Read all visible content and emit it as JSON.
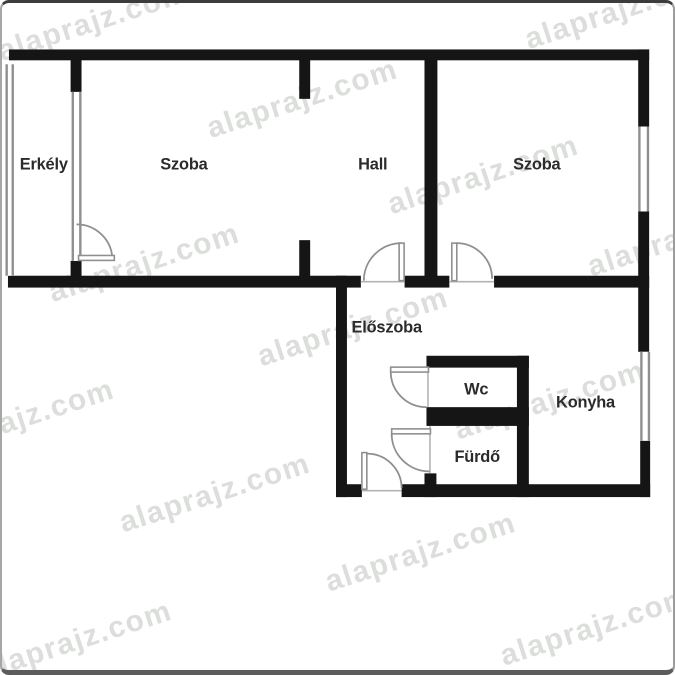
{
  "plan_title": "apartment-floor-plan",
  "colors": {
    "wall": "#151515",
    "door": "#8f8f8f",
    "door_fill": "#ffffff",
    "window": "#8f8f8f",
    "window_fill": "#ffffff",
    "threshold": "#b3b3b3",
    "label": "#2b2b2b",
    "watermark": "#dbdedb",
    "background": "#ffffff"
  },
  "watermark": {
    "text": "alaprajz.com",
    "rotation_deg": -18,
    "instances": [
      {
        "x": 95,
        "y": 28
      },
      {
        "x": 625,
        "y": 16
      },
      {
        "x": 305,
        "y": 106
      },
      {
        "x": 487,
        "y": 183
      },
      {
        "x": 688,
        "y": 246
      },
      {
        "x": 146,
        "y": 272
      },
      {
        "x": 356,
        "y": 337
      },
      {
        "x": 554,
        "y": 411
      },
      {
        "x": 20,
        "y": 430
      },
      {
        "x": 217,
        "y": 505
      },
      {
        "x": 424,
        "y": 565
      },
      {
        "x": 600,
        "y": 640
      },
      {
        "x": 78,
        "y": 654
      }
    ]
  },
  "rooms": [
    {
      "id": "erkely",
      "label": "Erkély",
      "x": 42,
      "y": 164
    },
    {
      "id": "szoba-left",
      "label": "Szoba",
      "x": 183,
      "y": 164
    },
    {
      "id": "hall",
      "label": "Hall",
      "x": 373,
      "y": 164
    },
    {
      "id": "szoba-right",
      "label": "Szoba",
      "x": 538,
      "y": 164
    },
    {
      "id": "eloszoba",
      "label": "Előszoba",
      "x": 387,
      "y": 329
    },
    {
      "id": "wc",
      "label": "Wc",
      "x": 477,
      "y": 392
    },
    {
      "id": "konyha",
      "label": "Konyha",
      "x": 587,
      "y": 405
    },
    {
      "id": "furdo",
      "label": "Fürdő",
      "x": 478,
      "y": 460
    }
  ],
  "plan": {
    "walls": [
      {
        "name": "wall-exterior-top",
        "x": 7,
        "y": 47,
        "w": 644,
        "h": 11
      },
      {
        "name": "wall-exterior-right-1",
        "x": 640,
        "y": 47,
        "w": 11,
        "h": 78
      },
      {
        "name": "wall-exterior-right-2",
        "x": 640,
        "y": 211,
        "w": 11,
        "h": 142
      },
      {
        "name": "wall-exterior-right-3",
        "x": 642,
        "y": 443,
        "w": 10,
        "h": 57
      },
      {
        "name": "wall-erkely-partition",
        "x": 69,
        "y": 56,
        "w": 11,
        "h": 34
      },
      {
        "name": "wall-erkely-stub",
        "x": 69,
        "y": 261,
        "w": 11,
        "h": 17
      },
      {
        "name": "wall-hall-stub-top",
        "x": 299,
        "y": 56,
        "w": 11,
        "h": 41
      },
      {
        "name": "wall-hall-stub-bottom",
        "x": 299,
        "y": 240,
        "w": 11,
        "h": 38
      },
      {
        "name": "wall-hall-szoba-divider",
        "x": 425,
        "y": 56,
        "w": 13,
        "h": 222
      },
      {
        "name": "wall-mid-left",
        "x": 6,
        "y": 276,
        "w": 355,
        "h": 12
      },
      {
        "name": "wall-mid-center",
        "x": 405,
        "y": 276,
        "w": 45,
        "h": 12
      },
      {
        "name": "wall-mid-right",
        "x": 495,
        "y": 276,
        "w": 156,
        "h": 12
      },
      {
        "name": "wall-eloszoba-left",
        "x": 336,
        "y": 276,
        "w": 11,
        "h": 224
      },
      {
        "name": "wall-bottom-left",
        "x": 336,
        "y": 487,
        "w": 26,
        "h": 13
      },
      {
        "name": "wall-bottom-right",
        "x": 402,
        "y": 487,
        "w": 250,
        "h": 13
      },
      {
        "name": "wall-furdo-stub",
        "x": 425,
        "y": 476,
        "w": 12,
        "h": 24
      },
      {
        "name": "wall-wc-top",
        "x": 427,
        "y": 357,
        "w": 103,
        "h": 12
      },
      {
        "name": "wall-wc-furdo-divider",
        "x": 427,
        "y": 409,
        "w": 103,
        "h": 19
      },
      {
        "name": "wall-wc-furdo-right",
        "x": 518,
        "y": 357,
        "w": 12,
        "h": 143
      }
    ],
    "windows": [
      {
        "name": "window-erkely-outer",
        "x": 3.5,
        "y": 62,
        "w": 8.5,
        "h": 214
      },
      {
        "name": "window-erkely-inner",
        "x": 70,
        "y": 90,
        "w": 10,
        "h": 171
      },
      {
        "name": "window-szoba-right",
        "x": 640,
        "y": 125,
        "w": 11,
        "h": 86
      },
      {
        "name": "window-konyha",
        "x": 642,
        "y": 353,
        "w": 10,
        "h": 90
      }
    ],
    "thresholds": [
      {
        "name": "threshold-hall-door",
        "x1": 361,
        "y1": 282,
        "x2": 405,
        "y2": 282
      },
      {
        "name": "threshold-szoba-door",
        "x1": 450,
        "y1": 282,
        "x2": 495,
        "y2": 282
      },
      {
        "name": "threshold-entrance-door",
        "x1": 362,
        "y1": 493.5,
        "x2": 402,
        "y2": 493.5
      },
      {
        "name": "threshold-wc-door",
        "x1": 428.5,
        "y1": 369,
        "x2": 428.5,
        "y2": 409
      },
      {
        "name": "threshold-furdo-door",
        "x1": 430.5,
        "y1": 428,
        "x2": 430.5,
        "y2": 476
      }
    ],
    "doors": [
      {
        "name": "door-erkely",
        "leaf": {
          "x": 77,
          "y": 255.5,
          "w": 36,
          "h": 5
        },
        "arc": "M 75 224 A 36 36 0 0 1 111 260"
      },
      {
        "name": "door-hall",
        "leaf": {
          "x": 399.5,
          "y": 243,
          "w": 5,
          "h": 38
        },
        "arc": "M 364 281 A 38 38 0 0 1 402 243"
      },
      {
        "name": "door-szoba",
        "leaf": {
          "x": 452.5,
          "y": 243,
          "w": 5,
          "h": 38
        },
        "arc": "M 457 243 A 36 36 0 0 1 493 279"
      },
      {
        "name": "door-wc",
        "leaf": {
          "x": 391,
          "y": 368.5,
          "w": 38,
          "h": 5
        },
        "arc": "M 391 373 A 36 36 0 0 0 427 409"
      },
      {
        "name": "door-furdo",
        "leaf": {
          "x": 392,
          "y": 431,
          "w": 39,
          "h": 5
        },
        "arc": "M 392 436 A 38 38 0 0 0 430 474"
      },
      {
        "name": "door-entrance",
        "leaf": {
          "x": 362,
          "y": 455,
          "w": 5,
          "h": 37
        },
        "arc": "M 367 456 A 35 35 0 0 1 402 491"
      }
    ]
  }
}
